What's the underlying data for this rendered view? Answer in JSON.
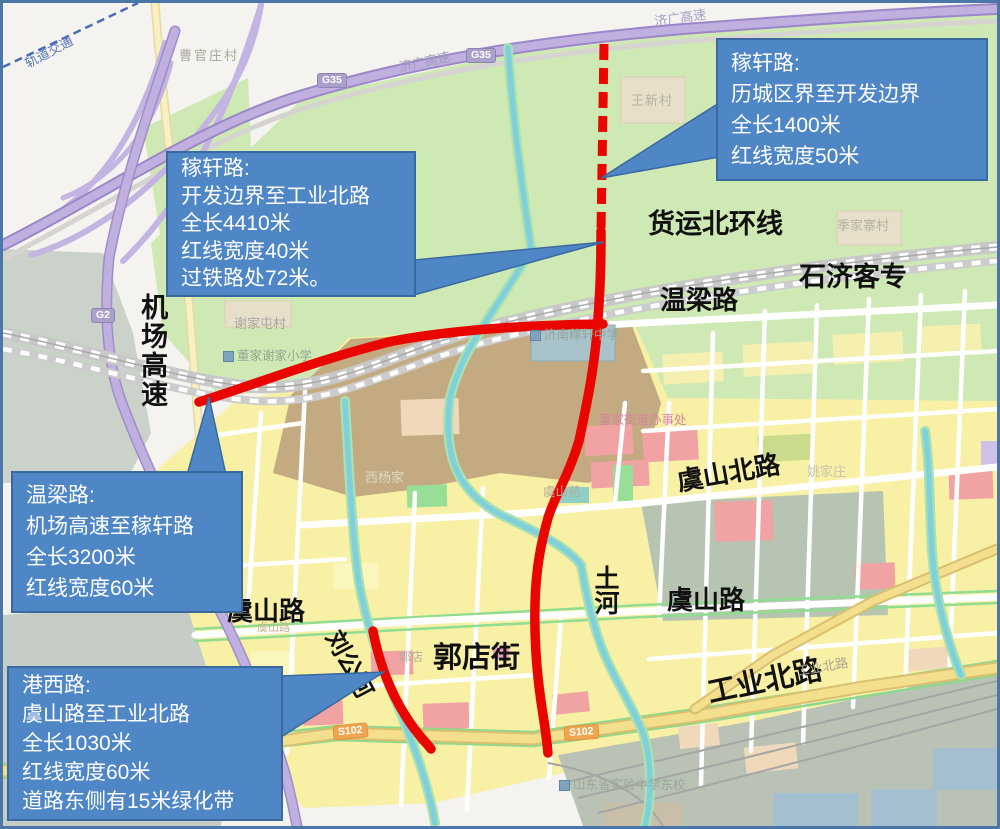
{
  "colors": {
    "highlight_road": "#ea0600",
    "callout_bg": "#4f86c6",
    "callout_border": "#39699f",
    "callout_text": "#ffffff"
  },
  "callouts": [
    {
      "title": "稼轩路:",
      "lines": [
        "历城区界至开发边界",
        "全长1400米",
        "红线宽度50米"
      ]
    },
    {
      "title": "稼轩路:",
      "lines": [
        "开发边界至工业北路",
        "全长4410米",
        "红线宽度40米",
        "过铁路处72米。"
      ]
    },
    {
      "title": "温梁路:",
      "lines": [
        "机场高速至稼轩路",
        "全长3200米",
        "红线宽度60米"
      ]
    },
    {
      "title": "港西路:",
      "lines": [
        "虞山路至工业北路",
        "全长1030米",
        "红线宽度60米",
        "道路东侧有15米绿化带"
      ]
    }
  ],
  "map_labels": {
    "major": {
      "airport_expressway": "机场高速",
      "freight_north_loop": "货运北环线",
      "wenliang_road": "温梁路",
      "shiji_passenger_rail": "石济客专",
      "yushan_north_road": "虞山北路",
      "yushan_road_west": "虞山路",
      "yushan_road_east": "虞山路",
      "tu_river": "土河",
      "guodian_street": "郭店街",
      "liugong_river": "刘公河",
      "gongye_north_road": "工业北路"
    },
    "minor": {
      "caoguanzhuangcun": "曹官庄村",
      "wangxincun": "王新村",
      "jijiazhaicun": "季家寨村",
      "xiejiatuncun": "谢家屯村",
      "dongjia_xiejia_primary": "董家谢家小学",
      "jinan_jiaxuan_middle": "济南稼轩中学",
      "dongjia_subdistrict_office": "董家街道办事处",
      "xiyangjia": "西杨家",
      "yaojiazhuang": "姚家庄",
      "yushanyuan": "虞山苑",
      "guodian": "郭店",
      "shandong_experimental_east": "山东省实验中学东校",
      "jiguang_expressway_a": "济广高速",
      "jiguang_expressway_b": "济广高速",
      "gongye_north_road_small": "工业北路",
      "yushan_road_small": "虞山路",
      "rail_transit": "轨道交通"
    },
    "badges": {
      "g35_a": "G35",
      "g35_b": "G35",
      "g2": "G2",
      "s102_a": "S102",
      "s102_b": "S102"
    }
  }
}
